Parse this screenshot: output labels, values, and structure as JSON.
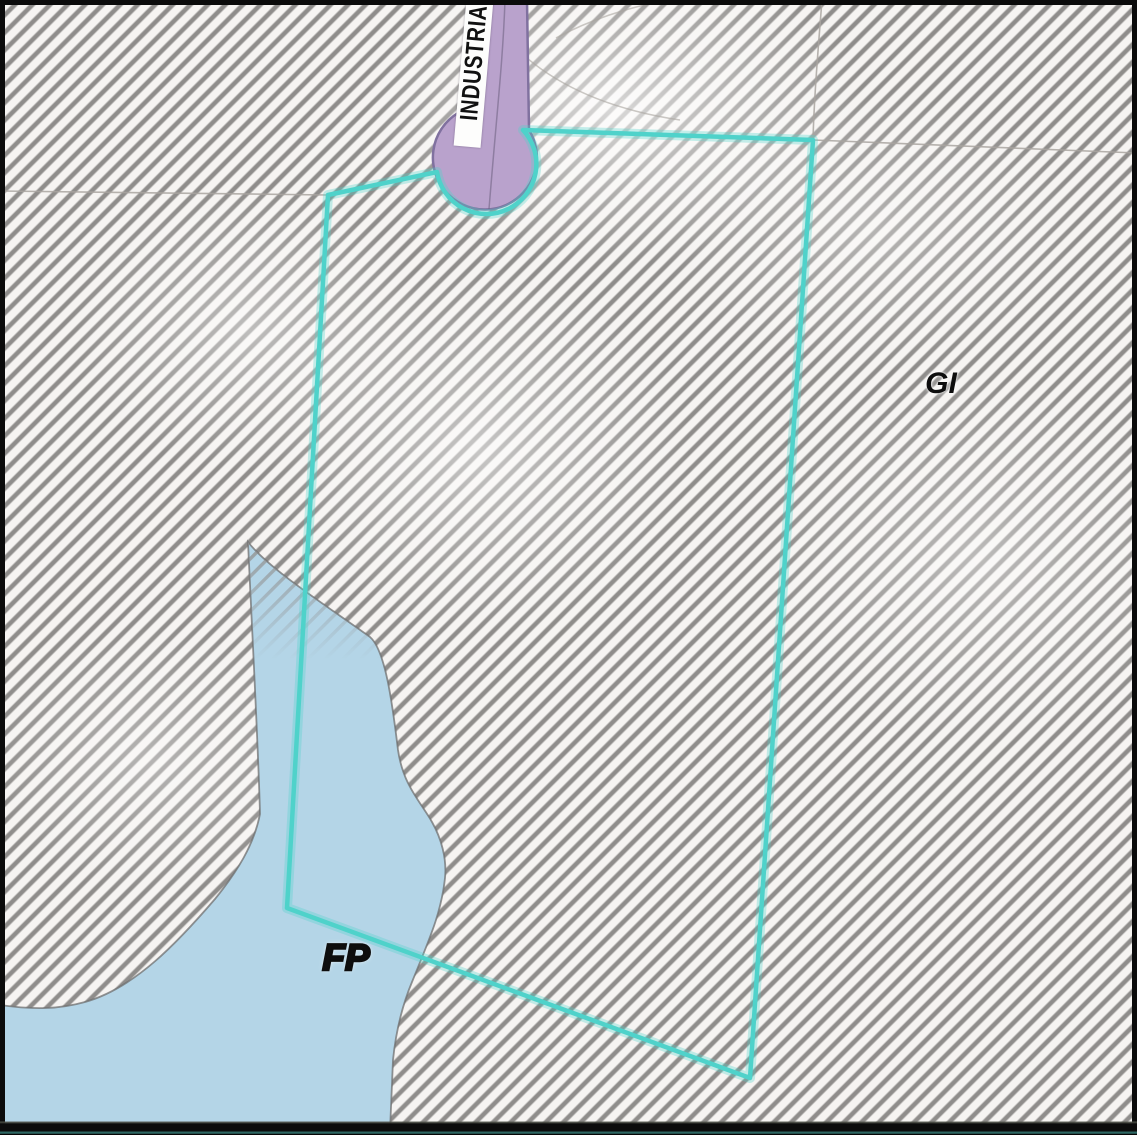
{
  "map": {
    "street_label": "INDUSTRIAL",
    "zone_labels": {
      "general_industrial": "GI",
      "floodplain": "FP"
    },
    "colors": {
      "parcel_highlight": "#4fd2ca",
      "road_fill": "#b9a2cc",
      "road_outline": "#80719f",
      "floodplain_fill": "#b4d5e7",
      "floodplain_outline": "#6f6f6f",
      "hatch_line": "#8f8d8b",
      "hatch_background": "#f6f4f2",
      "street_label_background": "#fdfdfc",
      "frame": "#0b0b0b"
    }
  }
}
